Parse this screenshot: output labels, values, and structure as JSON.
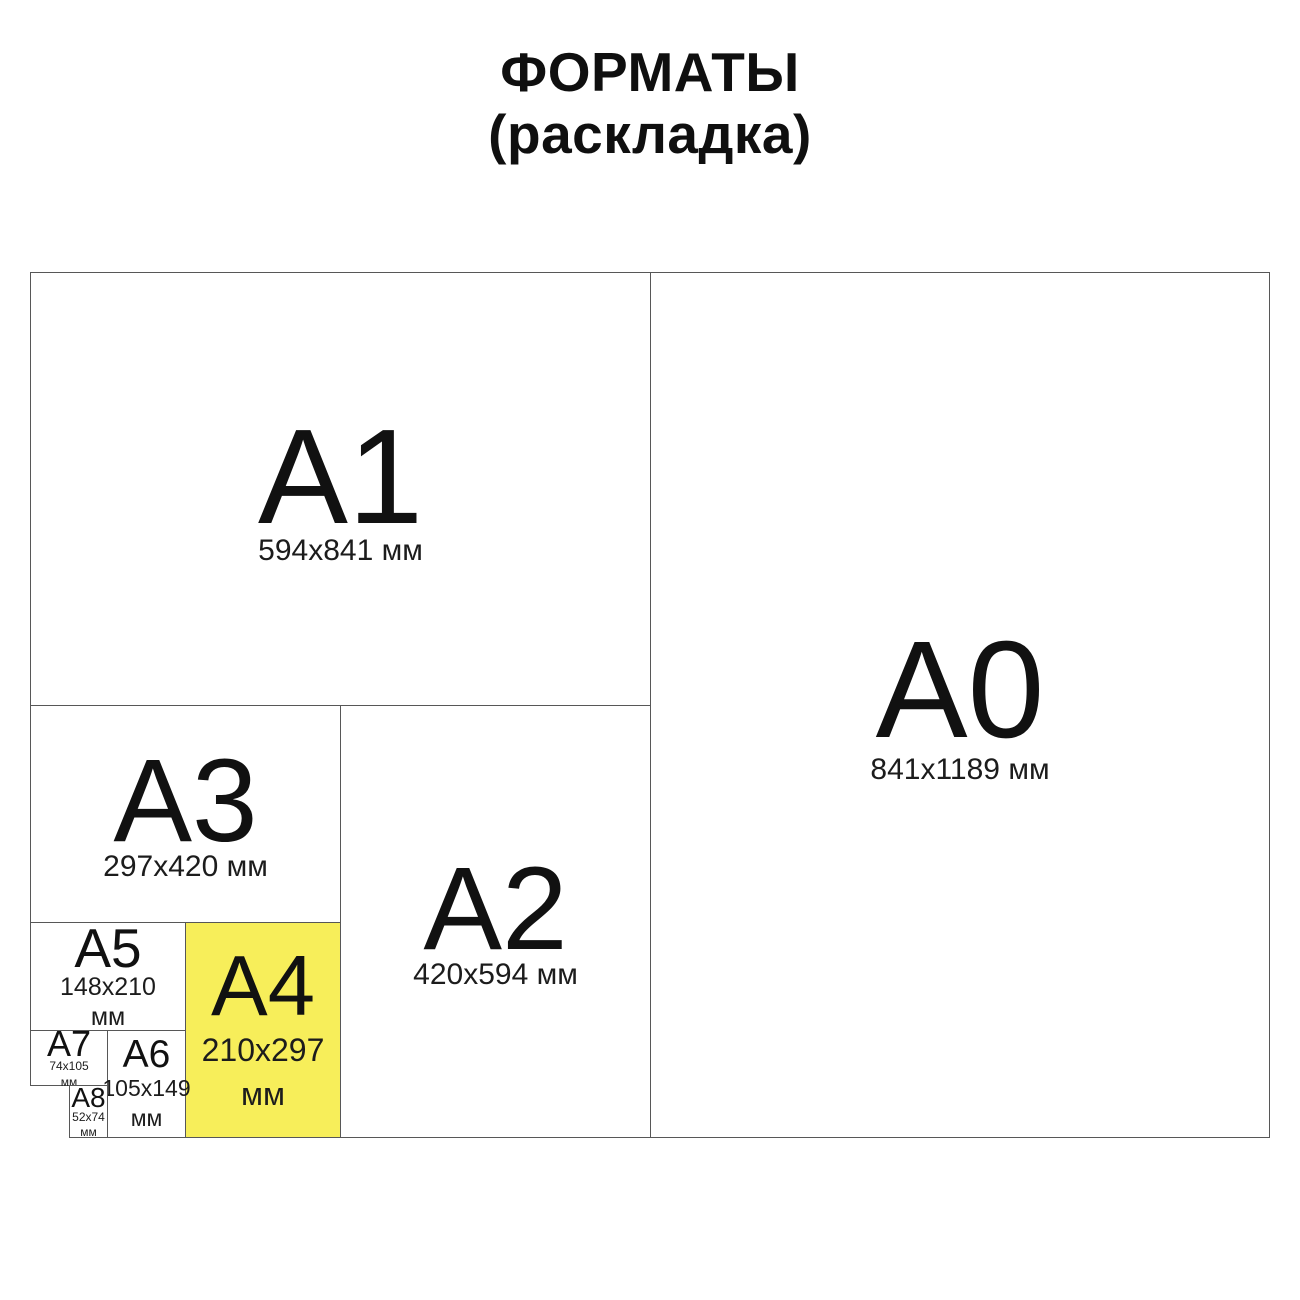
{
  "title": {
    "line1": "ФОРМАТЫ",
    "line2": "(раскладка)"
  },
  "colors": {
    "highlight_yellow": "#f7ee5a",
    "line_gray": "#575757",
    "text_black": "#111111",
    "background": "#ffffff"
  },
  "formats": {
    "a0": {
      "label": "A0",
      "dims_lines": [
        "841x1189 мм"
      ],
      "highlighted": false
    },
    "a1": {
      "label": "A1",
      "dims_lines": [
        "594x841 мм"
      ],
      "highlighted": false
    },
    "a2": {
      "label": "A2",
      "dims_lines": [
        "420x594 мм"
      ],
      "highlighted": false
    },
    "a3": {
      "label": "A3",
      "dims_lines": [
        "297x420 мм"
      ],
      "highlighted": false
    },
    "a4": {
      "label": "A4",
      "dims_lines": [
        "210x297",
        "мм"
      ],
      "highlighted": true
    },
    "a5": {
      "label": "A5",
      "dims_lines": [
        "148x210",
        "мм"
      ],
      "highlighted": false
    },
    "a6": {
      "label": "A6",
      "dims_lines": [
        "105x149",
        "мм"
      ],
      "highlighted": false
    },
    "a7": {
      "label": "A7",
      "dims_lines": [
        "74x105",
        "мм"
      ],
      "highlighted": false
    },
    "a8": {
      "label": "A8",
      "dims_lines": [
        "52x74",
        "мм"
      ],
      "highlighted": false
    }
  }
}
